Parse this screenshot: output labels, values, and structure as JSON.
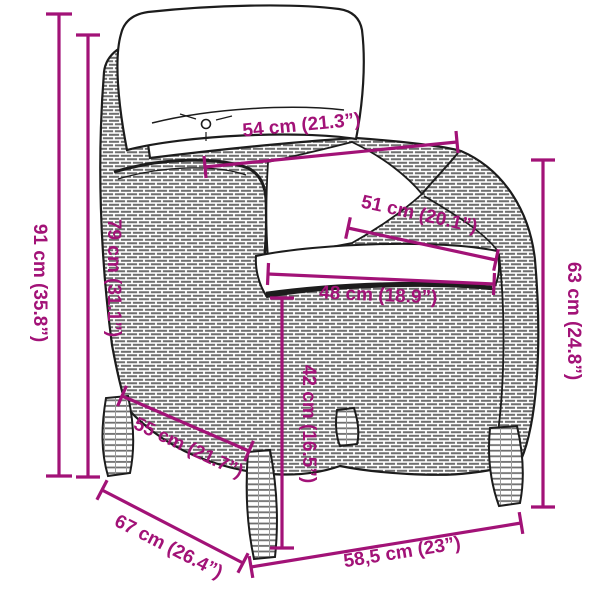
{
  "page": {
    "background_color": "#ffffff",
    "accent_color": "#A21277",
    "line_art_color": "#1c1c1c"
  },
  "diagram": {
    "type": "product-dimension-drawing",
    "subject": "poly-rattan garden armchair with cushions",
    "dimensions": {
      "total_height": {
        "label": "91 cm (35.8”)",
        "orientation": "vertical"
      },
      "back_height": {
        "label": "79 cm (31.1”)",
        "orientation": "vertical"
      },
      "top_width": {
        "label": "54 cm (21.3”)",
        "orientation": "horizontal"
      },
      "seat_back_width": {
        "label": "51 cm (20.1”)",
        "orientation": "diagonal"
      },
      "seat_front_width": {
        "label": "48 cm (18.9”)",
        "orientation": "diagonal"
      },
      "seat_height": {
        "label": "42 cm (16.5”)",
        "orientation": "vertical"
      },
      "arm_side_height": {
        "label": "63 cm (24.8”)",
        "orientation": "vertical"
      },
      "seat_depth": {
        "label": "55 cm (21.7”)",
        "orientation": "diagonal"
      },
      "total_depth": {
        "label": "67 cm (26.4”)",
        "orientation": "diagonal"
      },
      "base_width": {
        "label": "58,5 cm (23”)",
        "orientation": "diagonal"
      }
    }
  }
}
